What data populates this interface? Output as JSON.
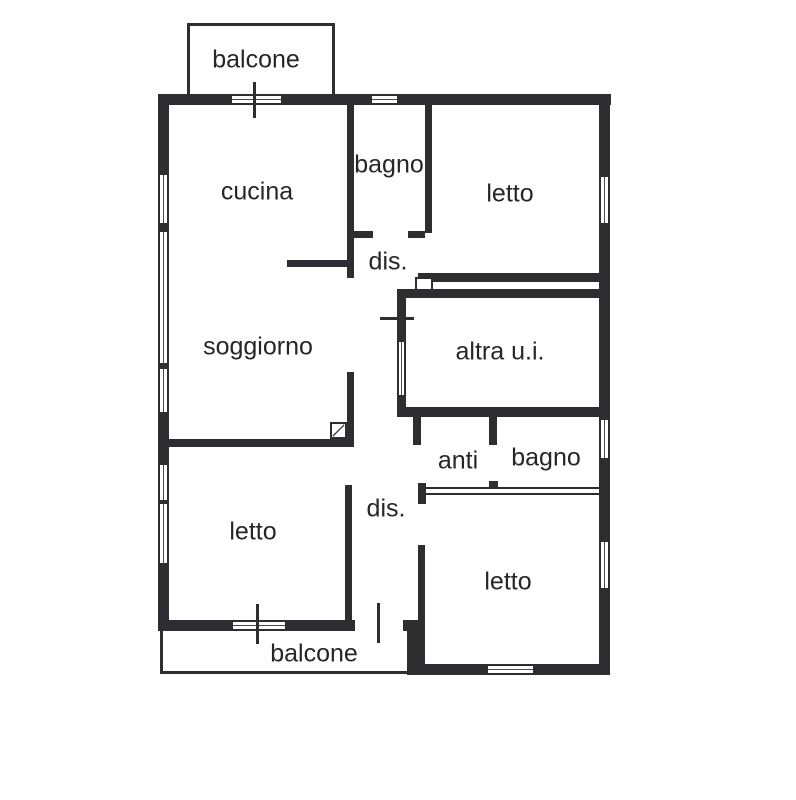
{
  "drawing": {
    "type": "floor-plan",
    "background": "#ffffff",
    "line_color": "#2d2d32",
    "text_color": "#26262a"
  },
  "rooms": {
    "balcone_top": "balcone",
    "cucina": "cucina",
    "bagno_top": "bagno",
    "letto_top_right": "letto",
    "dis_top": "dis.",
    "soggiorno": "soggiorno",
    "altra_ui": "altra u.i.",
    "anti": "anti",
    "bagno_bottom": "bagno",
    "letto_bottom_left": "letto",
    "dis_bottom": "dis.",
    "letto_bottom_right": "letto",
    "balcone_bottom": "balcone"
  }
}
